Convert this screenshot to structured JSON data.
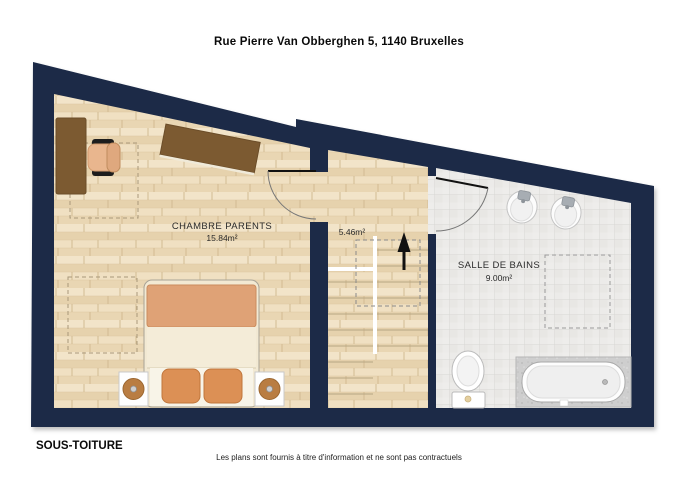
{
  "header": {
    "title": "Rue Pierre Van Obberghen 5, 1140 Bruxelles"
  },
  "footer": {
    "level_label": "SOUS-TOITURE",
    "disclaimer": "Les plans sont fournis à titre d'information et ne sont pas contractuels"
  },
  "plan": {
    "rooms": [
      {
        "id": "chambre-parents",
        "name": "CHAMBRE PARENTS",
        "area": "15.84m²"
      },
      {
        "id": "palier-escalier",
        "name": "",
        "area": "5.46m²"
      },
      {
        "id": "salle-de-bains",
        "name": "SALLE DE BAINS",
        "area": "9.00m²"
      }
    ],
    "colors": {
      "wall": "#1a2946",
      "wood_floor": "#eddcbc",
      "tile_floor": "#ecebe9",
      "furniture_wood": "#7c5a31",
      "textile_accent": "#dc9055"
    }
  }
}
